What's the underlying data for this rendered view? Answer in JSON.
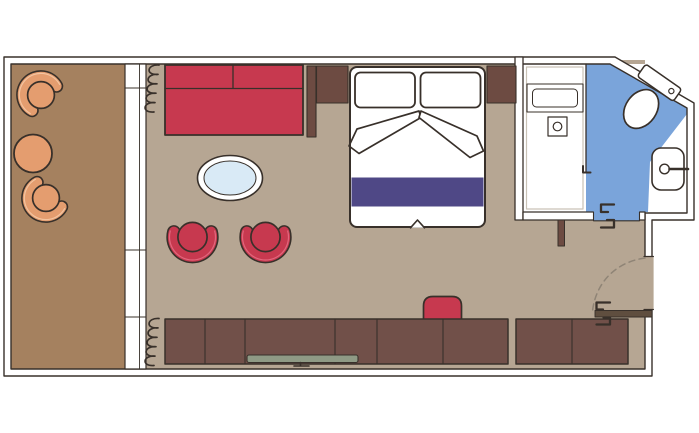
{
  "colors": {
    "background": "#ffffff",
    "outline": "#38302a",
    "wall": "#ffffff",
    "balcony_floor": "#a5815f",
    "room_floor": "#b6a693",
    "bathroom_floor_white": "#ffffff",
    "bathroom_floor_blue": "#7aa4da",
    "upholstery_red": "#c7394f",
    "upholstery_red_highlight": "#e2677d",
    "bed_runner_purple": "#4f4886",
    "bed_white": "#ffffff",
    "cabinet_brown": "#715049",
    "headboard_brown": "#6d4b42",
    "rattan_orange": "#e49d6f",
    "rattan_orange_highlight": "#f3c4a0",
    "tv_gray_green": "#8f9a85",
    "table_glass_blue": "#d9eaf6",
    "door_leaf_brown": "#5f4e3f",
    "dashed_arc_gray": "#8f8476",
    "liner_gray": "#c9c2b6"
  },
  "items": [
    {
      "id": "balcony",
      "name": "balcony-with-rattan-chairs-and-table"
    },
    {
      "id": "sliding-door",
      "name": "balcony-sliding-glass-door"
    },
    {
      "id": "curtains",
      "name": "curtain-coil-symbols"
    },
    {
      "id": "sofa",
      "name": "red-two-seat-sofa"
    },
    {
      "id": "coffee-table",
      "name": "oval-glass-coffee-table"
    },
    {
      "id": "chairs",
      "name": "two-red-tub-chairs"
    },
    {
      "id": "bed",
      "name": "double-bed-with-pillows-duvet-folds-and-purple-runner"
    },
    {
      "id": "sideboard",
      "name": "sideboard-with-tv"
    },
    {
      "id": "wardrobe",
      "name": "wardrobe-unit"
    },
    {
      "id": "stool",
      "name": "red-desk-stool"
    },
    {
      "id": "entry-door",
      "name": "entry-door-with-swing-arc"
    },
    {
      "id": "bathroom",
      "name": "bathroom-shower-toilet-sink"
    }
  ]
}
